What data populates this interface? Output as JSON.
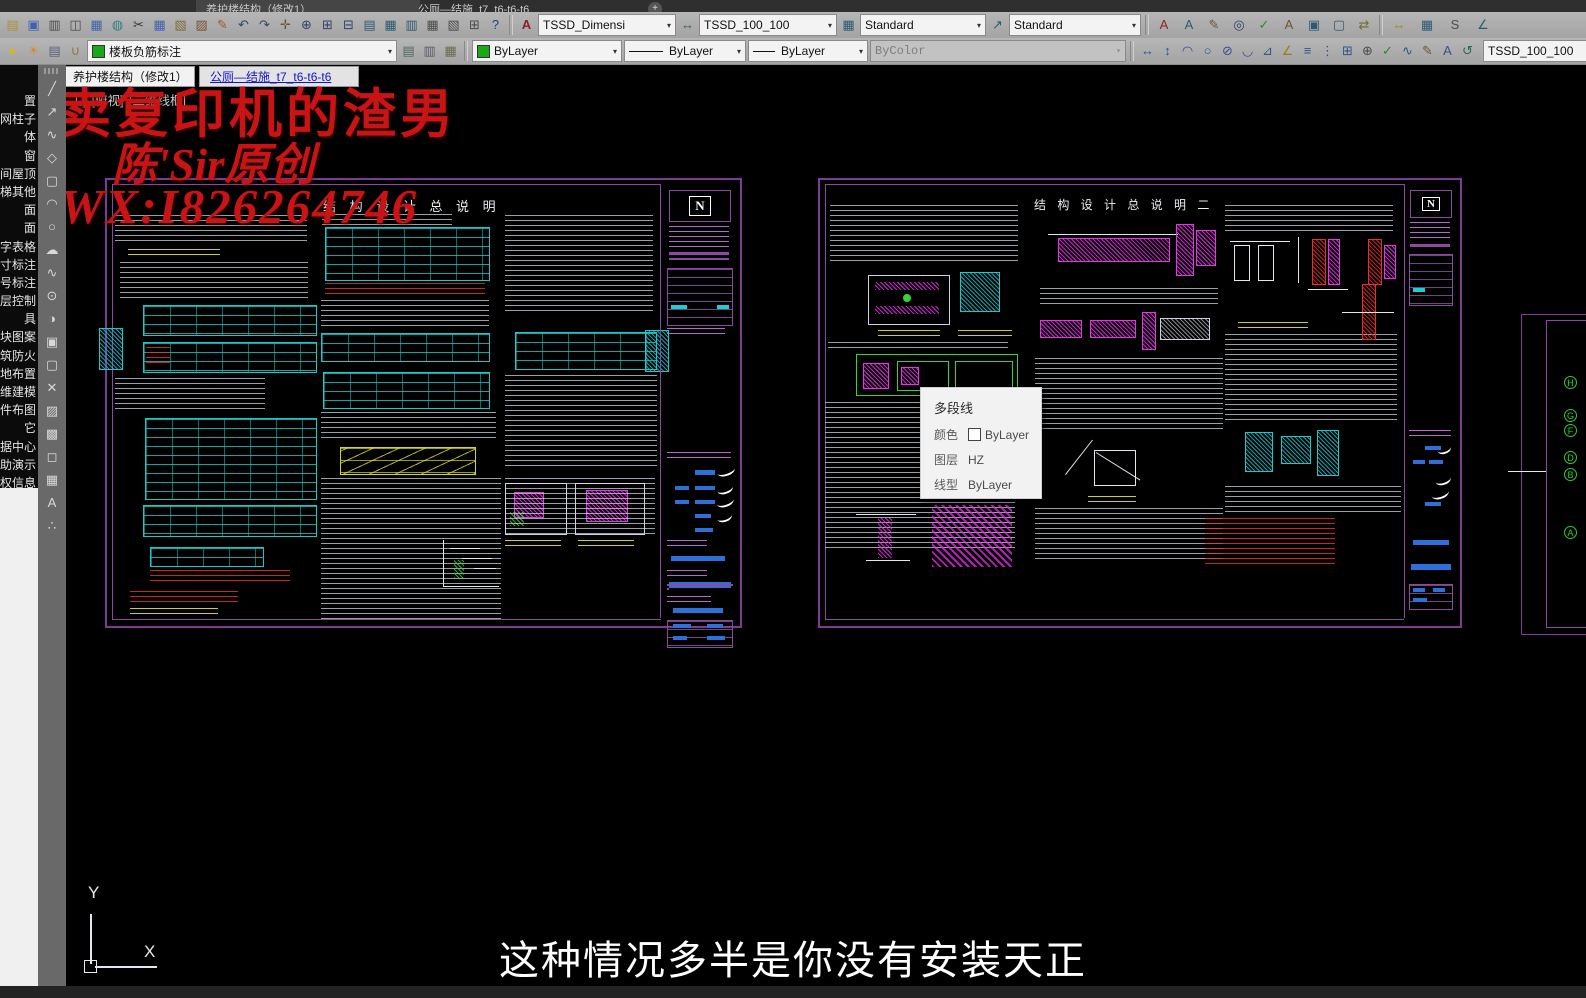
{
  "window": {
    "file_tab1": "养护楼结构（修改1）",
    "file_tab2": "公厕—结施_t7_t6-t6-t6",
    "plus": "+"
  },
  "tb1": {
    "text_style": "TSSD_Dimensi",
    "dim_style": "TSSD_100_100",
    "table_style": "Standard",
    "mleader_style": "Standard",
    "icons": [
      {
        "n": "open-icon",
        "g": "▤",
        "c": "#b08f3a"
      },
      {
        "n": "save-icon",
        "g": "▣",
        "c": "#3f62b0"
      },
      {
        "n": "plot-icon",
        "g": "▥",
        "c": "#4c4c4c"
      },
      {
        "n": "plot-preview-icon",
        "g": "◫",
        "c": "#4c4c4c"
      },
      {
        "n": "eplot-icon",
        "g": "▦",
        "c": "#3f62b0"
      },
      {
        "n": "publish-icon",
        "g": "◍",
        "c": "#2e8080"
      },
      {
        "n": "cut-icon",
        "g": "✂",
        "c": "#333333"
      },
      {
        "n": "copy-icon",
        "g": "▦",
        "c": "#3f62b0"
      },
      {
        "n": "paste-icon",
        "g": "▧",
        "c": "#7c6c32"
      },
      {
        "n": "paste-block-icon",
        "g": "▨",
        "c": "#7c5030"
      },
      {
        "n": "match-properties-icon",
        "g": "✎",
        "c": "#a0591f"
      },
      {
        "n": "undo-icon",
        "g": "↶",
        "c": "#33426e"
      },
      {
        "n": "redo-icon",
        "g": "↷",
        "c": "#33426e"
      },
      {
        "n": "pan-icon",
        "g": "✛",
        "c": "#6e5433"
      },
      {
        "n": "zoom-realtime-icon",
        "g": "⊕",
        "c": "#33426e"
      },
      {
        "n": "zoom-window-icon",
        "g": "⊞",
        "c": "#33426e"
      },
      {
        "n": "zoom-previous-icon",
        "g": "⊟",
        "c": "#33426e"
      },
      {
        "n": "properties-palette-icon",
        "g": "▤",
        "c": "#2c5a72"
      },
      {
        "n": "design-center-icon",
        "g": "▦",
        "c": "#2c5a72"
      },
      {
        "n": "tool-palettes-icon",
        "g": "▥",
        "c": "#2c5a72"
      },
      {
        "n": "sheet-set-manager-icon",
        "g": "▦",
        "c": "#4c4c4c"
      },
      {
        "n": "markup-manager-icon",
        "g": "▧",
        "c": "#4c4c4c"
      },
      {
        "n": "quickcalc-icon",
        "g": "⊞",
        "c": "#4c4c4c"
      },
      {
        "n": "help-icon",
        "g": "?",
        "c": "#24408a"
      }
    ],
    "text_icons": [
      {
        "n": "text-style-icon",
        "g": "A",
        "c": "#8a2424"
      },
      {
        "n": "mtext-icon",
        "g": "A",
        "c": "#2c5a72"
      },
      {
        "n": "edit-text-icon",
        "g": "✎",
        "c": "#6e5433"
      },
      {
        "n": "find-text-icon",
        "g": "◎",
        "c": "#33426e"
      },
      {
        "n": "spell-check-icon",
        "g": "✓",
        "c": "#2a8a2a"
      },
      {
        "n": "text-match-icon",
        "g": "A",
        "c": "#6e5433"
      },
      {
        "n": "text-frame-icon",
        "g": "▣",
        "c": "#2c5a72"
      },
      {
        "n": "text-mask-icon",
        "g": "▢",
        "c": "#2c5a72"
      },
      {
        "n": "move-text-icon",
        "g": "⇄",
        "c": "#6e6e2a"
      }
    ],
    "tssd_icons": [
      {
        "n": "tssd-dim-icon",
        "g": "↔",
        "c": "#a08a10"
      },
      {
        "n": "tssd-copy-icon",
        "g": "▦",
        "c": "#2c5a72"
      },
      {
        "n": "tssd-scroll-icon",
        "g": "S",
        "c": "#4c4c4c"
      },
      {
        "n": "tssd-angle-icon",
        "g": "∠",
        "c": "#2c5a72"
      }
    ]
  },
  "tb2": {
    "layer_name": "楼板负筋标注",
    "color": "ByLayer",
    "linetype": "ByLayer",
    "lineweight": "ByLayer",
    "plot_style": "ByColor",
    "tssd_style": "TSSD_100_100",
    "status_icons": [
      {
        "n": "layer-on-bulb-icon",
        "g": "●",
        "c": "#d8b22a"
      },
      {
        "n": "layer-thaw-sun-icon",
        "g": "☀",
        "c": "#d88a2a"
      },
      {
        "n": "layer-settings-icon",
        "g": "▤",
        "c": "#55607a"
      },
      {
        "n": "layer-unlock-icon",
        "g": "∪",
        "c": "#8a7a3a"
      }
    ],
    "layer_tools": [
      {
        "n": "layer-states-icon",
        "g": "▤",
        "c": "#4a6a5a"
      },
      {
        "n": "layer-previous-icon",
        "g": "▥",
        "c": "#5a5a6a"
      },
      {
        "n": "layer-match-icon",
        "g": "▦",
        "c": "#6a6a4a"
      }
    ],
    "dim_icons": [
      {
        "n": "dim-linear-icon",
        "g": "↔",
        "c": "#33528a"
      },
      {
        "n": "dim-aligned-icon",
        "g": "↕",
        "c": "#33528a"
      },
      {
        "n": "dim-arc-icon",
        "g": "◠",
        "c": "#33528a"
      },
      {
        "n": "dim-radius-icon",
        "g": "○",
        "c": "#33528a"
      },
      {
        "n": "dim-jogged-icon",
        "g": "⊘",
        "c": "#33528a"
      },
      {
        "n": "dim-diameter-icon",
        "g": "◡",
        "c": "#33528a"
      },
      {
        "n": "dim-angular-icon",
        "g": "⊿",
        "c": "#33528a"
      },
      {
        "n": "quick-dim-icon",
        "g": "∠",
        "c": "#a07a1a"
      },
      {
        "n": "dim-baseline-icon",
        "g": "≡",
        "c": "#33528a"
      },
      {
        "n": "dim-continue-icon",
        "g": "⋮",
        "c": "#33528a"
      },
      {
        "n": "dim-space-icon",
        "g": "⊞",
        "c": "#33528a"
      },
      {
        "n": "dim-break-icon",
        "g": "⊕",
        "c": "#4c4c4c"
      },
      {
        "n": "dim-check-icon",
        "g": "✓",
        "c": "#2a8a2a"
      },
      {
        "n": "dim-jog-line-icon",
        "g": "∿",
        "c": "#33528a"
      },
      {
        "n": "dim-edit-icon",
        "g": "✎",
        "c": "#6e5433"
      },
      {
        "n": "dim-text-edit-icon",
        "g": "A",
        "c": "#33528a"
      },
      {
        "n": "dim-update-icon",
        "g": "↺",
        "c": "#2a6a4a"
      }
    ]
  },
  "left_menu": {
    "items": [
      "置",
      "网柱子",
      "体",
      "窗",
      "间屋顶",
      "梯其他",
      "面",
      "面",
      "字表格",
      "寸标注",
      "号标注",
      "层控制",
      "具",
      "块图案",
      "筑防火",
      "地布置",
      "维建模",
      "件布图",
      "它",
      "据中心",
      "助演示",
      "权信息"
    ]
  },
  "draw_icons": [
    {
      "n": "line-icon",
      "g": "╱"
    },
    {
      "n": "xline-icon",
      "g": "↗"
    },
    {
      "n": "polyline-icon",
      "g": "∿"
    },
    {
      "n": "polygon-icon",
      "g": "◇"
    },
    {
      "n": "rectangle-icon",
      "g": "▢"
    },
    {
      "n": "arc-icon",
      "g": "◠"
    },
    {
      "n": "circle-icon",
      "g": "○"
    },
    {
      "n": "revcloud-icon",
      "g": "☁"
    },
    {
      "n": "spline-icon",
      "g": "∿"
    },
    {
      "n": "ellipse-icon",
      "g": "⊙"
    },
    {
      "n": "ellipse-arc-icon",
      "g": "◑"
    },
    {
      "n": "insert-block-icon",
      "g": "▣"
    },
    {
      "n": "make-block-icon",
      "g": "▢"
    },
    {
      "n": "point-icon",
      "g": "✕"
    },
    {
      "n": "hatch-icon",
      "g": "▨"
    },
    {
      "n": "gradient-icon",
      "g": "▩"
    },
    {
      "n": "region-icon",
      "g": "◻"
    },
    {
      "n": "table-icon",
      "g": "▦"
    },
    {
      "n": "mtext-a-icon",
      "g": "A"
    },
    {
      "n": "divide-icon",
      "g": "∴"
    }
  ],
  "canvas": {
    "doc_tab1": "养护楼结构（修改1）",
    "doc_tab2": "公厕—结施_t7_t6-t6-t6",
    "vp_minus": "[-]",
    "vp_view": "[俯视]",
    "vp_style": "[二维线框]",
    "sheet1_title": "结 构 设 计 总 说 明",
    "sheet2_title": "结 构 设 计 总 说 明 二",
    "logo_letter": "N",
    "ucs_x": "X",
    "ucs_y": "Y",
    "wm1": "卖复印机的渣男",
    "wm2": "陈'Sir原创",
    "wm3": "WX:I826264746",
    "subtitle": "这种情况多半是你没有安装天正",
    "grid_bubbles": [
      "H",
      "G",
      "F",
      "D",
      "B",
      "A"
    ]
  },
  "tooltip": {
    "title": "多段线",
    "r1l": "颜色",
    "r1v": "ByLayer",
    "r2l": "图层",
    "r2v": "HZ",
    "r3l": "线型",
    "r3v": "ByLayer"
  },
  "colors": {
    "sheet_border": "#7d3a96",
    "table_cyan": "#19c9c9",
    "detail_magenta": "#ee2eee",
    "detail_green": "#35d435",
    "note_yellow": "#dcdc28",
    "alert_red": "#eb2d2d",
    "titleblock_blue": "#2e6fd8",
    "watermark_red": "#c81414"
  }
}
